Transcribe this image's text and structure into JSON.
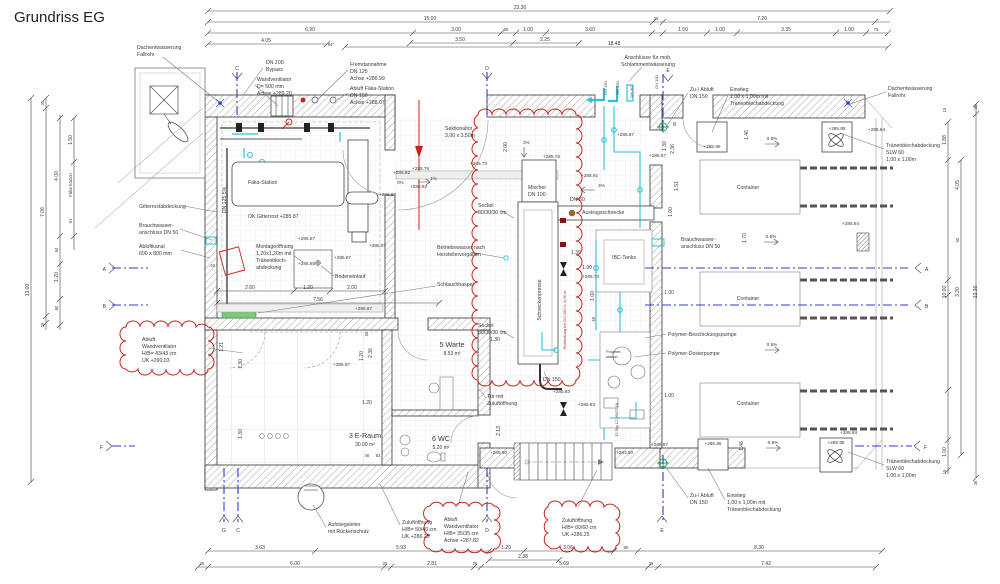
{
  "title": "Grundriss EG",
  "colors": {
    "revision_red": "#c3271b",
    "pipe_cyan": "#2fc1d6",
    "section_blue": "#2c3ed0",
    "fitting_green": "#18a558"
  },
  "dtop": [
    "23.30",
    "15.00",
    "35",
    "7.20",
    "6.90",
    "3.00",
    "50",
    "1.00",
    "3.60",
    "1.50",
    "1.00",
    "3.35",
    "1.00",
    "75",
    "4.05",
    "64°",
    "3.50",
    "2.25",
    "18.48"
  ],
  "dbot": [
    "3.63",
    "5.93",
    "1.20",
    "3.06",
    "80",
    "8.30",
    "2.38",
    "35",
    "6.00",
    "25",
    "2.81",
    "25",
    "5.69",
    "35",
    "7.42"
  ],
  "dleft": [
    "13.00",
    "35",
    "7.06",
    "25",
    "1.50",
    "4.00",
    "Fäka-Station",
    "91",
    "94",
    "1.20",
    "90"
  ],
  "dright": [
    "15",
    "35",
    "1.88",
    "4.05",
    "50",
    "10.00",
    "3.20",
    "12.36",
    "1.00",
    "15",
    "35"
  ],
  "idim": [
    "2.60",
    "1.20",
    "2.00",
    "7.56",
    ".40",
    "1.21",
    "1.30",
    "1.30",
    "50",
    "1.20",
    "2.36",
    "1.20",
    "40",
    "92",
    "2.00",
    "1.35",
    "1.90",
    "1.00",
    "60",
    "1.30",
    "2.13",
    "30",
    "1.30",
    "2.36",
    "1.51",
    "1.00",
    "1.46",
    "1.70",
    "1.00",
    "1.00",
    "1.46"
  ],
  "elev": [
    "+285.82",
    "0%",
    "+285.87",
    "+285.76",
    "1%",
    "+285.82",
    "+285.73",
    "+285.76",
    "+285.91",
    "3%",
    "3%",
    "+285.87",
    "+285.87",
    "+285.85",
    "+285.87",
    "+285.87",
    "+285.87",
    "+285.87",
    "+285.87",
    "+285.86",
    "+285.85",
    "+285.84",
    "+285.84",
    "+285.73",
    "+285.83",
    "+285.83",
    "+285.80",
    "+283.60",
    "+285.87",
    "+285.86",
    "+285.85",
    "+285.84",
    "0.5%",
    "0.5%",
    "0.5%",
    "0.5%"
  ],
  "labels": {
    "dach": [
      "Dachentwässerung",
      "Fallrohr"
    ],
    "dn200": [
      "DN 200",
      "Bypass"
    ],
    "wandvent": [
      "Wandventilator",
      "D= 500 mm",
      "Achse +289.20"
    ],
    "fremd": [
      "Fremdannahme",
      "DN 125",
      "Achse +286.99"
    ],
    "abluftfaeka": [
      "Abluft Fäka-Station",
      "DN 150",
      "Achse +288.07"
    ],
    "anschl": [
      "Anschlüsse für mob.",
      "Schlammentwässerung"
    ],
    "zuabluft": [
      "Zu-/ Abluft",
      "DN 150"
    ],
    "einstieg": [
      "Einstieg",
      "1,00 x 1,00m mit",
      "Tränenblechabdeckung"
    ],
    "traenen": [
      "Tränenblechabdeckung",
      "SLW 60",
      "1,00 x 1,00m"
    ],
    "gitterrost": [
      "Gitterrostabdeckung"
    ],
    "brauch": [
      "Brauchwasser-",
      "anschluss DN 50"
    ],
    "abluftkanal": [
      "Abluftkanal",
      "600 x 800 mm"
    ],
    "cloudleft": [
      "Abluft",
      "Wandventilator",
      "H/B= 43/43 cm",
      "UK +290.03"
    ],
    "poly1": [
      "Polymer-Beschickungspumpe"
    ],
    "poly2": [
      "Polymer-Dosierpumpe"
    ],
    "aufstieg": [
      "Aufstiegsleiter",
      "mit Rückenschutz"
    ],
    "zuluft5040": [
      "Zuluftöffnung",
      "H/B= 50/40 cm",
      "UK +286.25"
    ],
    "cloudabluft": [
      "Abluft",
      "Wandventilator",
      "H/B= 35/35 cm",
      "Achse +287.82"
    ],
    "cloudzuluft": [
      "Zuluftöffnung",
      "H/B= 60/60 cm",
      "UK +286.25"
    ],
    "sektionaltor": [
      "Sektionaltor",
      "3,00 x 3,50m"
    ],
    "faeka": [
      "Fäka-Station"
    ],
    "okgitter": [
      "OK Gitterrost +285.87"
    ],
    "dn125": [
      "DN 125  5%"
    ],
    "montage": [
      "Montageöffnung",
      "1,20x1,20m mit",
      "Tränenblech-",
      "abdeckung"
    ],
    "bodeneinlauf": [
      "Bodeneinlauf"
    ],
    "mischer": [
      "Mischer",
      "DN 100"
    ],
    "sockel": [
      "Sockel",
      "80/30/30 cm"
    ],
    "betriebsw": [
      "Betriebswasser nach",
      "Herstellervorgaben"
    ],
    "schlauch": [
      "Schlauchhaspel"
    ],
    "schnecke": [
      "Schneckenpresse"
    ],
    "rohrleitung": [
      "Rohrleitung für DN 250 l= 4,05 m"
    ],
    "dn80": [
      "DN 80"
    ],
    "austrag": [
      "Austragsschnecke"
    ],
    "ibc": [
      "IBC-Tanks"
    ],
    "polystation": [
      "Polymer-",
      "station"
    ],
    "tuer": [
      "Tür mit",
      "Zuluftöffnung"
    ],
    "dn150": [
      "DN 150"
    ],
    "stg": [
      "12 Stg 17.26/27.18"
    ],
    "container": [
      "Container"
    ],
    "warte": [
      "5 Warte",
      "8.53 m²"
    ],
    "eraum": [
      "3 E-Raum",
      "30.00 m²"
    ],
    "wc": [
      "6 WC",
      "5.20 m²"
    ],
    "dnf": [
      "DN 150",
      "DN 150",
      "DN 80",
      "DN 100"
    ]
  },
  "markers": {
    "a": "A",
    "b": "B",
    "c": "C",
    "d": "D",
    "e": "E",
    "f": "F",
    "g": "G"
  }
}
